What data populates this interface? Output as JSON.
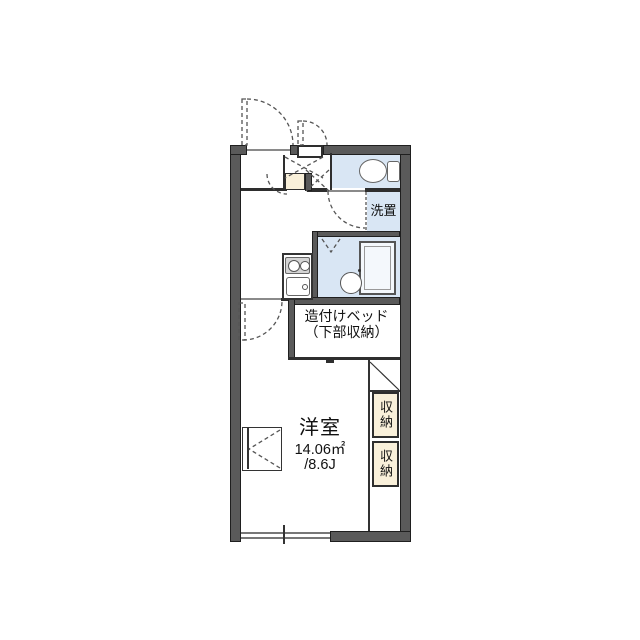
{
  "floorplan": {
    "kind": "japanese-apartment-floor-plan",
    "labels": {
      "main_room_name": "洋室",
      "main_room_area_sqm": "14.06㎡",
      "main_room_area_tatami": "/8.6J",
      "built_in_bed_line1": "造付けベッド",
      "built_in_bed_line2": "（下部収納）",
      "washer_space": "洗置",
      "storage_upper": "収納",
      "storage_lower": "収納"
    },
    "colors": {
      "wall": "#5a5a5a",
      "wet_area_fill": "#d9e6f4",
      "storage_fill": "#f9f0da",
      "line": "#333333",
      "background": "#ffffff"
    }
  }
}
